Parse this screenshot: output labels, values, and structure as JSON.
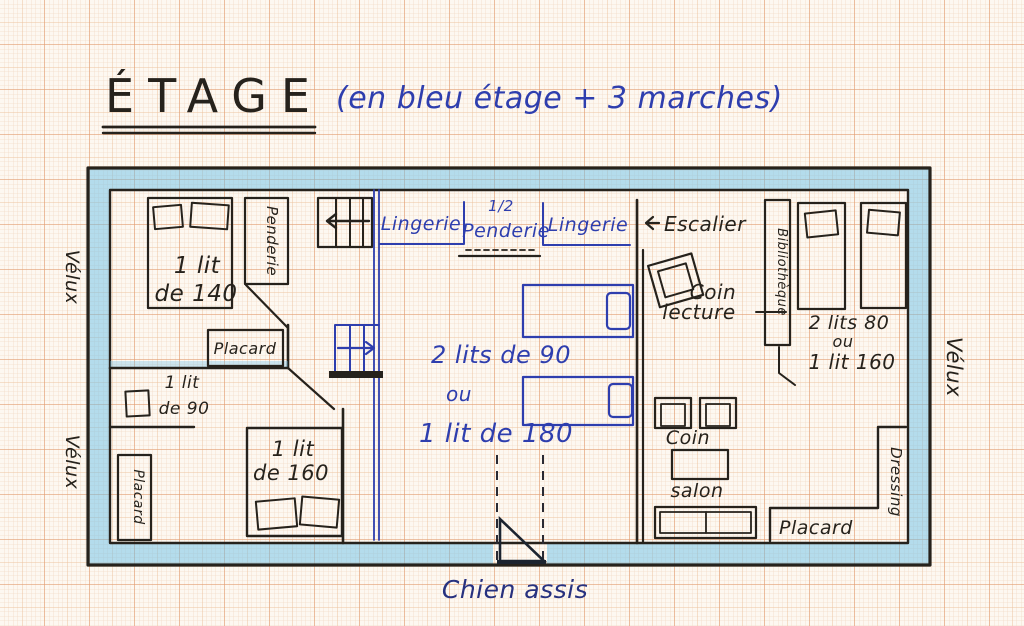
{
  "title": {
    "main": "ÉTAGE",
    "annotation": "(en bleu étage + 3 marches)"
  },
  "legend_colors": {
    "paper": "#fdf8f1",
    "grid_fine": "#f3dcc8",
    "grid_major": "#e29d72",
    "wall_highlight_blue": "#6cc0e8",
    "ink_black": "#26221c",
    "ink_blue": "#2e3eae"
  },
  "exterior": {
    "velux_left_top": "Vélux",
    "velux_left_bottom": "Vélux",
    "velux_right": "Vélux",
    "dormer": "Chien assis"
  },
  "top_left_bedroom": {
    "bed_line1": "1 lit",
    "bed_line2": "de 140",
    "wardrobe": "Penderie",
    "cupboard": "Placard"
  },
  "landing": {
    "closet_left": "Lingerie",
    "closet_mid_line1": "1/2",
    "closet_mid_line2": "Penderie",
    "closet_right": "Lingerie",
    "stairs": "Escalier"
  },
  "middle_bedroom": {
    "beds_line1": "2 lits de 90",
    "beds_line2": "ou",
    "beds_line3": "1 lit de 180"
  },
  "bottom_left_bedroom": {
    "small_bed_line1": "1 lit",
    "small_bed_line2": "de 90",
    "cupboard": "Placard",
    "big_bed_line1": "1 lit",
    "big_bed_line2": "de 160"
  },
  "right_room": {
    "reading_line1": "Coin",
    "reading_line2": "lecture",
    "bookcase": "Bibliothèque",
    "beds_line1": "2 lits 80",
    "beds_line2": "ou",
    "beds_line3": "1 lit 160",
    "salon_line1": "Coin",
    "salon_line2": "salon",
    "cupboard": "Placard",
    "dressing": "Dressing"
  }
}
